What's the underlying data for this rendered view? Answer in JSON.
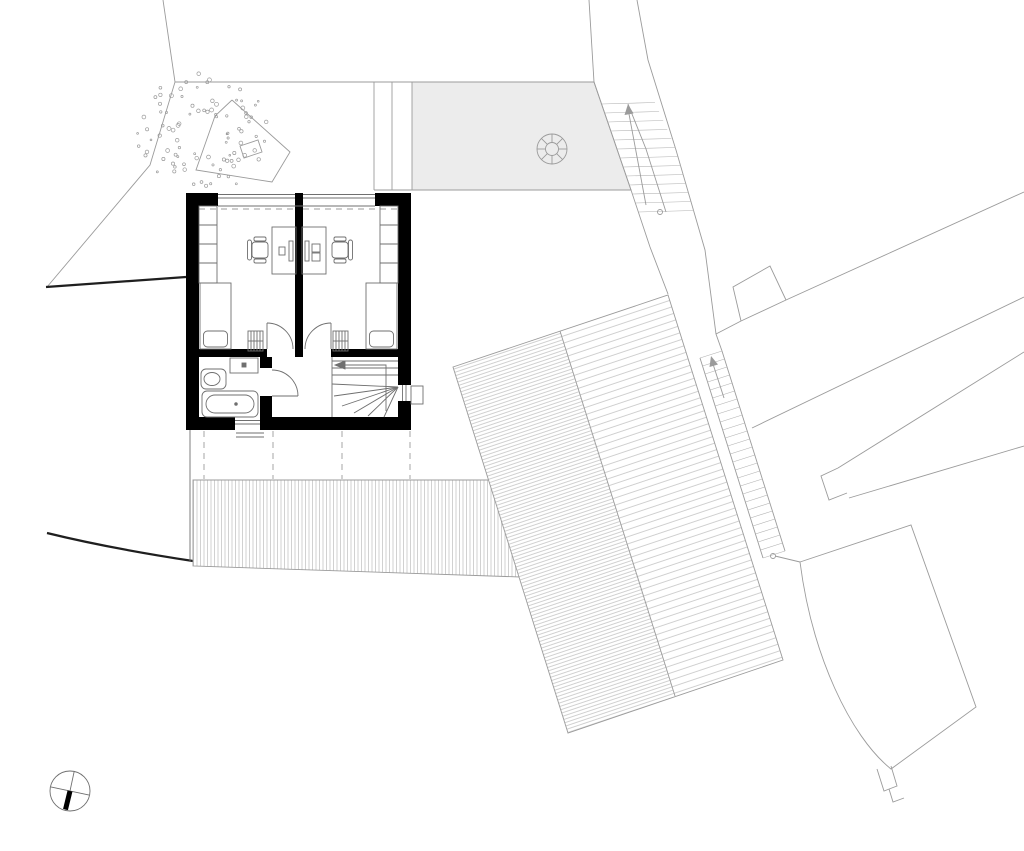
{
  "page": {
    "background": "#ffffff",
    "kind": "architectural floor plan, upper floor"
  },
  "colors": {
    "paper": "#ffffff",
    "wall": "#000000",
    "line_light": "#9b9b9b",
    "line_medium": "#6f6f6f",
    "line_dark": "#1f1f1f",
    "hatch": "#b2b2b2",
    "terrace_fill": "#ececec",
    "furniture": "#6f6f6f",
    "needle": "#000000"
  },
  "tree": {
    "cx": 204,
    "cy": 134,
    "r_min": 22,
    "r_max": 66,
    "count": 95
  },
  "stairs": {
    "top_right": {
      "y_start": 104,
      "y_end": 212,
      "step": 9
    },
    "roof_side": {
      "x1": 700,
      "y1": 358,
      "x2": 722,
      "y2": 351,
      "dx": 63,
      "dy": 200,
      "treads": 25
    }
  },
  "elements": [
    "site-boundary",
    "terrace",
    "round-table",
    "garden-tree",
    "external-stairs-upper",
    "external-stairs-roof-side",
    "neighbour-building-upper",
    "neighbour-building-lower",
    "neighbour-parcel",
    "pitched-roof",
    "lower-roof",
    "bedroom-left",
    "bedroom-right",
    "bathroom",
    "hall",
    "winder-stair",
    "desk",
    "office-chair",
    "bed",
    "wardrobe",
    "radiator",
    "bathtub",
    "wc",
    "washbasin",
    "north-arrow"
  ]
}
